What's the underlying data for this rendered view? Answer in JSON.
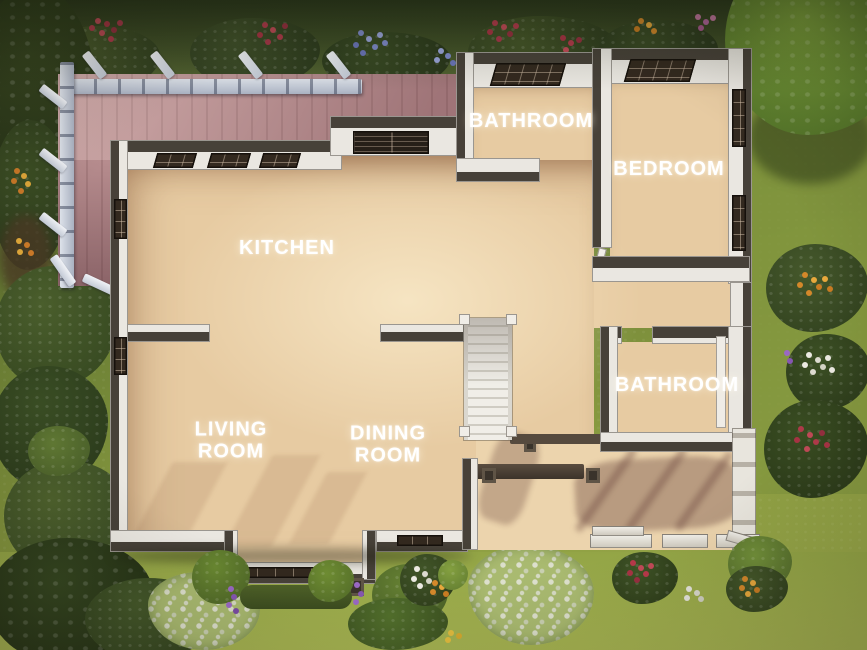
{
  "scene": {
    "view": "overhead-floor-plan",
    "labels": {
      "bathroom_top": "BATHROOM",
      "bedroom": "BEDROOM",
      "kitchen": "KITCHEN",
      "bathroom_right": "BATHROOM",
      "living_room": "LIVING\nROOM",
      "dining_room": "DINING\nROOM"
    },
    "colors": {
      "label_text": "#ffffff",
      "floor_wood": "#e7cba2",
      "porch_wood": "#ecd4ad",
      "deck_wood": "#c49a9b",
      "wall_face": "#eae7e1",
      "wall_edge": "#474139",
      "pergola": "#c3cad6",
      "grass_dark": "#46561f",
      "grass_light": "#9fae4c"
    }
  }
}
